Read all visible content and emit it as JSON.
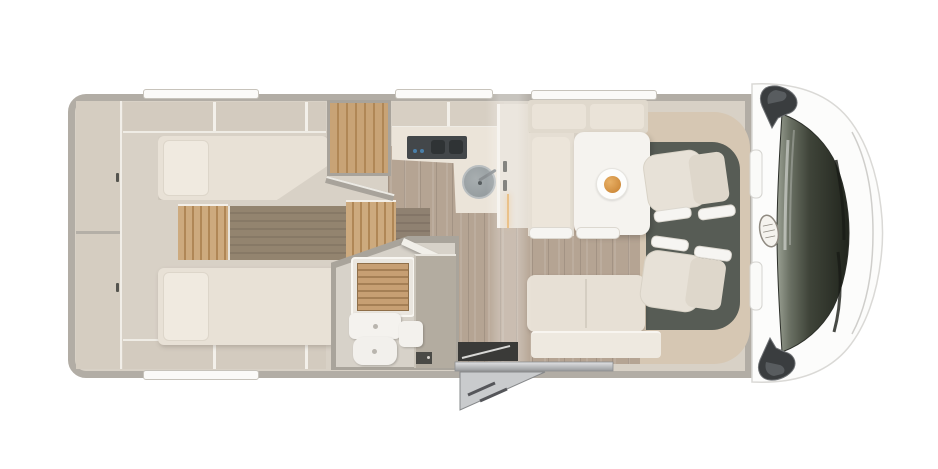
{
  "meta": {
    "description": "Top-down floor plan rendering of a motorhome (camper) interior layout",
    "background": "#ffffff",
    "view": "plan-view"
  },
  "palette": {
    "wall": "#b2ada5",
    "floor_base": "#d8d1c6",
    "corridor_wood": "#b5a493",
    "podium_wood_dark": "#93846f",
    "step_wood": "#c9a377",
    "mattress": "#e8e1d6",
    "pillow": "#f0eae0",
    "cabinet": "#d3cbbf",
    "counter": "#ebe4d9",
    "hob": "#43474a",
    "sink": "#9ba2a5",
    "table": "#f5f3ef",
    "plate_food": "#d99843",
    "seat_cream": "#e6e0d5",
    "cab_floor": "#575c55",
    "dashboard": "#d6c7b3",
    "cab_shell": "#fcfcfb",
    "windshield_dark": "#3f4439",
    "mirror": "#3a3d3f",
    "step_metal": "#c9cbcd",
    "led_strip": "#e2a95c"
  },
  "areas": {
    "vehicle": "Motorhome floor plan, plan view",
    "rear_cabinet": "Rear wall cabinet column",
    "bed_top": "Rear twin bed (driver side)",
    "bed_bottom": "Rear twin bed (habitation side)",
    "bed_steps": "Wooden steps between twin beds",
    "podium": "Raised dark wood bed podium",
    "wardrobe": "Wardrobe",
    "kitchen": "Kitchen block with hob and round sink",
    "fridge": "Tall cabinet / refrigerator with handles",
    "bathroom": "Bathroom with shower grate, toilet and vanity",
    "dinette": "Half-dinette with pedestal table",
    "plate": "Plate with food on table",
    "travel_bench": "Forward-facing travel bench",
    "entry": "Entrance door with folding entry step",
    "cab": "Driver cab with two swivel seats",
    "seat_driver": "Swivel cab seat (driver side)",
    "seat_passenger": "Swivel cab seat (passenger side)",
    "windshield": "Windshield with wipers",
    "mirror_top": "Exterior mirror (driver side)",
    "mirror_bottom": "Exterior mirror (passenger side)",
    "logo": "Manufacturer logo badge on cab roof",
    "roof_windows": "Wall/roof window slots"
  },
  "icons": {
    "logo_badge": "oval-brand-badge",
    "mirror": "wing-mirror",
    "entry_step": "fold-out-step"
  }
}
